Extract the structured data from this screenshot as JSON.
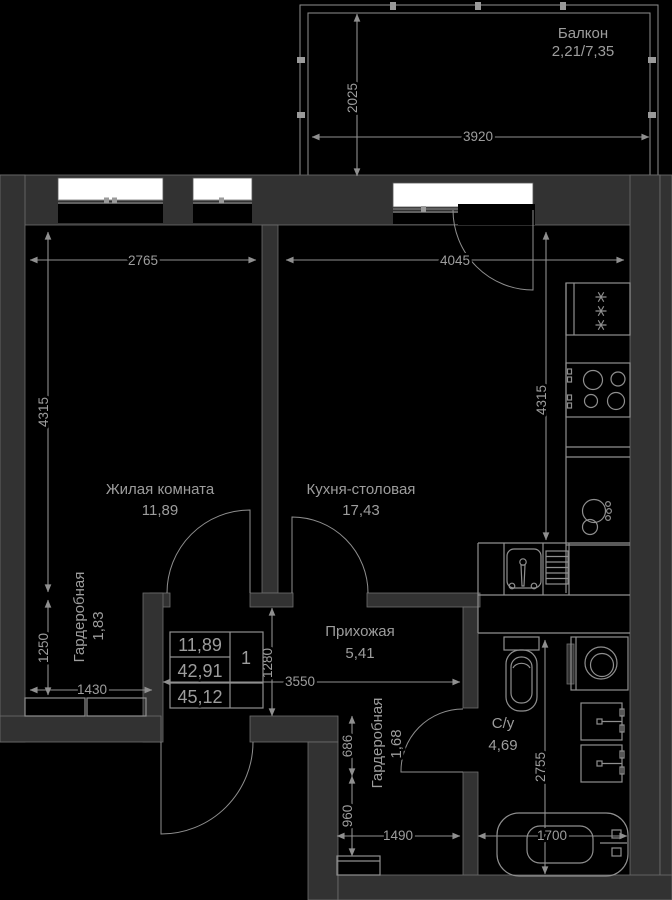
{
  "floorplan": {
    "balcony": {
      "name": "Балкон",
      "area": "2,21/7,35"
    },
    "rooms": {
      "living": {
        "name": "Жилая комната",
        "area": "11,89"
      },
      "kitchen": {
        "name": "Кухня-столовая",
        "area": "17,43"
      },
      "wardrobe_left": {
        "name": "Гардеробная",
        "area": "1,83"
      },
      "hallway": {
        "name": "Прихожая",
        "area": "5,41"
      },
      "wardrobe_low": {
        "name": "Гардеробная",
        "area": "1,68"
      },
      "bathroom": {
        "name": "С/у",
        "area": "4,69"
      }
    },
    "stats": {
      "living_area": "11,89",
      "area_without_balcony": "42,91",
      "total_area": "45,12",
      "rooms_count": "1"
    },
    "dimensions": {
      "balcony_depth": "2025",
      "balcony_length": "3920",
      "living_width": "2765",
      "kitchen_width": "4045",
      "living_depth": "4315",
      "kitchen_depth": "4315",
      "wardrobe_left_depth": "1250",
      "wardrobe_left_width": "1430",
      "hallway_depth": "1280",
      "hallway_width": "3550",
      "corridor_seg_upper": "686",
      "corridor_seg_lower": "960",
      "corridor_width": "1490",
      "bathtub_length": "1700",
      "bathroom_depth": "2755"
    },
    "colors": {
      "background": "#000000",
      "wall": "#323232",
      "line": "#8f8f8f",
      "text": "#9d9d9d",
      "window": "#ffffff"
    }
  }
}
